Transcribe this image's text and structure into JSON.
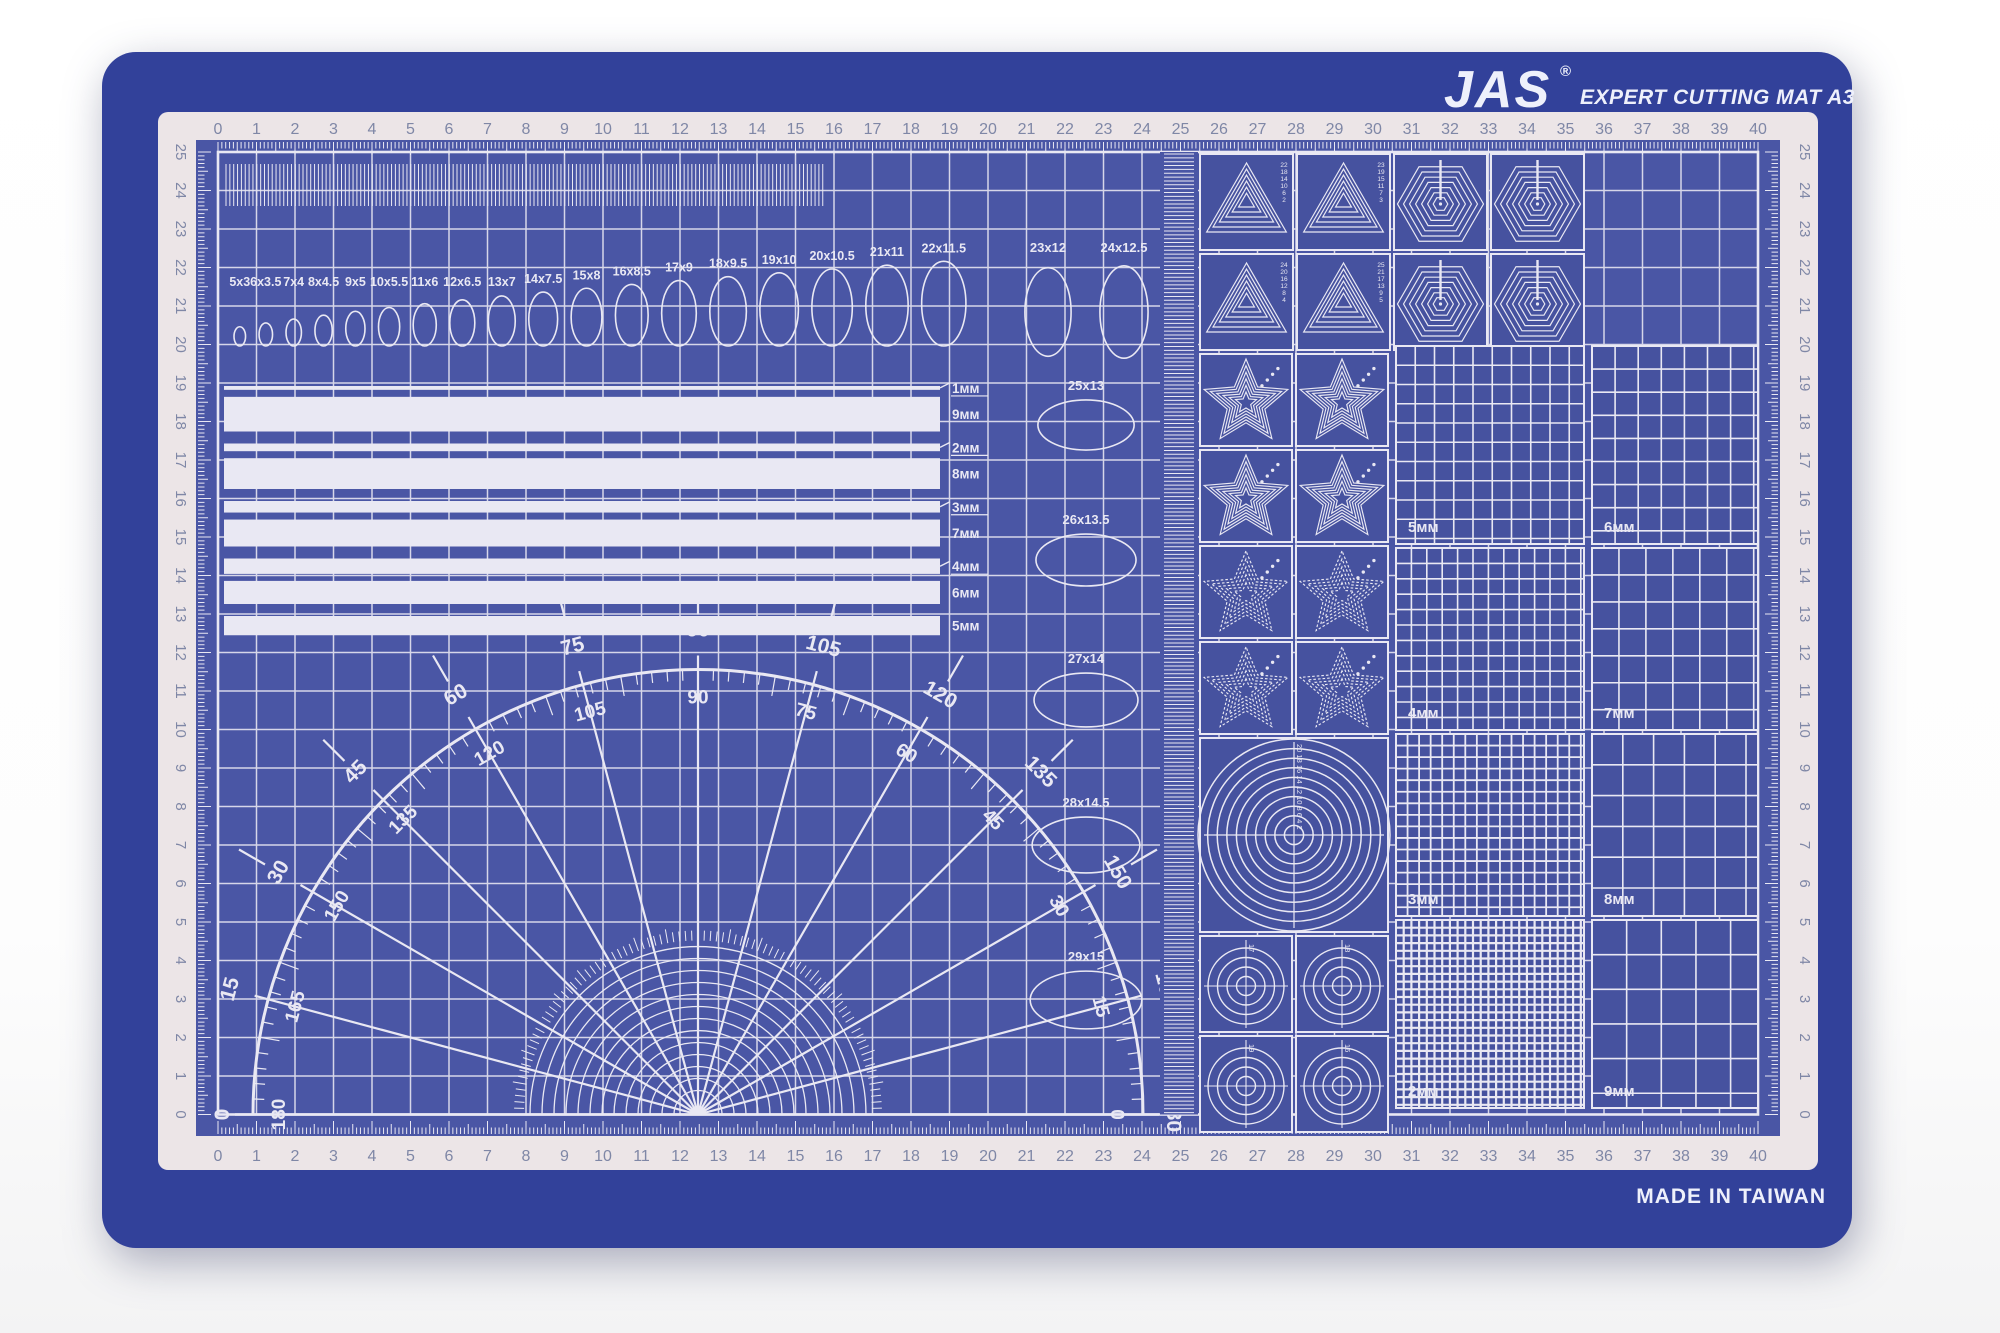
{
  "header": {
    "brand": "JAS",
    "reg": "®",
    "title": "EXPERT CUTTING MAT A3"
  },
  "footer": {
    "made_in": "MADE IN TAIWAN"
  },
  "colors": {
    "backdrop": "#ffffff",
    "mat_blue": "#32419a",
    "area_blue": "#4a56a5",
    "cell_blue": "#46529f",
    "print_white": "#e9e8f3",
    "frame_pale": "#ece5e7",
    "ruler_num": "#7f87a6"
  },
  "rulers": {
    "cm_numbers": [
      "0",
      "1",
      "2",
      "3",
      "4",
      "5",
      "6",
      "7",
      "8",
      "9",
      "10",
      "11",
      "12",
      "13",
      "14",
      "15",
      "16",
      "17",
      "18",
      "19",
      "20",
      "21",
      "22",
      "23",
      "24",
      "25",
      "26",
      "27",
      "28",
      "29",
      "30",
      "31",
      "32",
      "33",
      "34",
      "35",
      "36",
      "37",
      "38",
      "39",
      "40"
    ],
    "vertical_numbers": [
      "25",
      "24",
      "23",
      "22",
      "21",
      "20",
      "19",
      "18",
      "17",
      "16",
      "15",
      "14",
      "13",
      "12",
      "11",
      "10",
      "9",
      "8",
      "7",
      "6",
      "5",
      "4",
      "3",
      "2",
      "1",
      "0"
    ]
  },
  "ellipse_row_labels": [
    "5x3",
    "6x3.5",
    "7x4",
    "8x4.5",
    "9x5",
    "10x5.5",
    "11x6",
    "12x6.5",
    "13x7",
    "14x7.5",
    "15x8",
    "16x8.5",
    "17x9",
    "18x9.5",
    "19x10",
    "20x10.5",
    "21x11",
    "22x11.5"
  ],
  "ellipse_vertical_labels": [
    "23x12",
    "24x12.5"
  ],
  "ellipse_large_labels": [
    "25x13",
    "26x13.5",
    "27x14",
    "28x14.5",
    "29x15"
  ],
  "strip_pairs": [
    [
      "1мм",
      "9мм"
    ],
    [
      "2мм",
      "8мм"
    ],
    [
      "3мм",
      "7мм"
    ],
    [
      "4мм",
      "6мм"
    ],
    [
      "5мм"
    ]
  ],
  "strip_mm": [
    [
      1,
      9
    ],
    [
      2,
      8
    ],
    [
      3,
      7
    ],
    [
      4,
      6
    ],
    [
      5
    ]
  ],
  "protractor_labels": [
    {
      "angle": 0,
      "outer": "180",
      "inner": "0"
    },
    {
      "angle": 15,
      "outer": "165",
      "inner": "15"
    },
    {
      "angle": 30,
      "outer": "150",
      "inner": "30"
    },
    {
      "angle": 45,
      "outer": "135",
      "inner": "45"
    },
    {
      "angle": 60,
      "outer": "120",
      "inner": "60"
    },
    {
      "angle": 75,
      "outer": "105",
      "inner": "75"
    },
    {
      "angle": 90,
      "outer": "90",
      "inner": "90"
    },
    {
      "angle": 105,
      "outer": "75",
      "inner": "105"
    },
    {
      "angle": 120,
      "outer": "60",
      "inner": "120"
    },
    {
      "angle": 135,
      "outer": "45",
      "inner": "135"
    },
    {
      "angle": 150,
      "outer": "30",
      "inner": "150"
    },
    {
      "angle": 165,
      "outer": "15",
      "inner": "165"
    },
    {
      "angle": 180,
      "outer": "0",
      "inner": "180"
    }
  ],
  "triangle_numbers": [
    "22 18 14 10 6 2",
    "23 19 15 11 7 3",
    "24 20 16 12 8 4",
    "25 21 17 13 9 5"
  ],
  "grid_patches_left": [
    {
      "label": "5мм",
      "mm": 5
    },
    {
      "label": "4мм",
      "mm": 4
    },
    {
      "label": "3мм",
      "mm": 3
    },
    {
      "label": "2мм",
      "mm": 2
    }
  ],
  "grid_patches_right": [
    {
      "label": "6мм",
      "mm": 6
    },
    {
      "label": "7мм",
      "mm": 7
    },
    {
      "label": "8мм",
      "mm": 8
    },
    {
      "label": "9мм",
      "mm": 9
    }
  ],
  "target_numbers": {
    "big": "20 18 16 14 12 10 8 6 4 2",
    "small": [
      "17",
      "18",
      "19",
      "16"
    ]
  }
}
